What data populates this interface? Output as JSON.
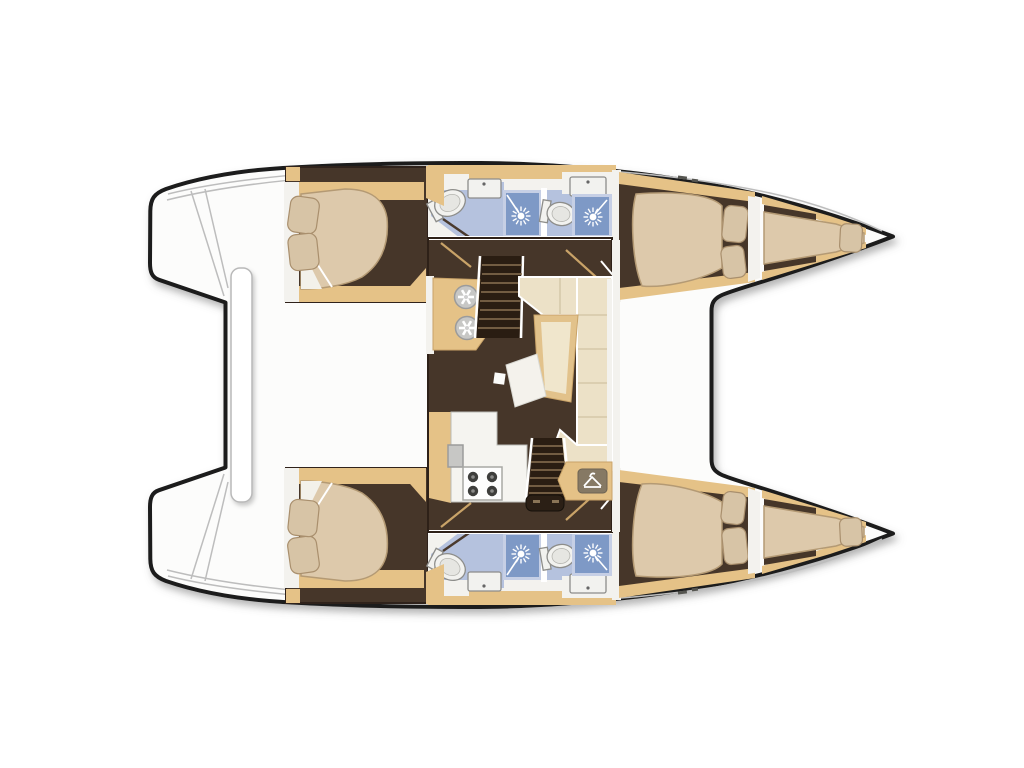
{
  "meta": {
    "title": "Catamaran floor plan — top view, 4 double cabins, 4 heads, 2 bow berths, central saloon",
    "image_type": "boat-layout-diagram",
    "orientation": "bows-pointing-right"
  },
  "palette": {
    "outline": "#1a1a1a",
    "deck": "#fcfcfb",
    "deckLine": "#bdbdbd",
    "wood": "#e5c287",
    "floorDark": "#463629",
    "bedCream": "#ddc9ab",
    "bedEdge": "#b49a74",
    "pillow": "#d7c4a6",
    "pillowEdge": "#a98f6d",
    "sheetWhite": "#f3f1ea",
    "bathFloor": "#b5c2de",
    "showerBlue": "#7e99c6",
    "showerFrame": "#c6cfe5",
    "fixtureWhite": "#f2f2ef",
    "fixtureStroke": "#8d8d8a",
    "sofaCream": "#ece1c7",
    "sofaSeam": "#d5c8a8",
    "tableTan": "#e2c28b",
    "padCream": "#f0e6cc",
    "stairDark": "#2a1d12",
    "stairTread": "#8a7252",
    "sinkGray": "#c7c7c5",
    "burnerDark": "#3e3e3c",
    "badgeGray": "#867964",
    "thresholdDark": "#2b1f15",
    "doorTan": "#c9a368",
    "white": "#ffffff"
  },
  "vessel": {
    "type": "catamaran",
    "hulls": [
      {
        "id": "upper-hull",
        "aft_cabin": {
          "bed": "double-berth",
          "pillows": 2
        },
        "heads": [
          {
            "id": "aft-head",
            "fixtures": [
              "toilet",
              "washbasin",
              "shower"
            ]
          },
          {
            "id": "forward-head",
            "fixtures": [
              "toilet",
              "washbasin",
              "shower"
            ]
          }
        ],
        "forward_cabin": {
          "bed": "double-berth",
          "pillows": 2
        },
        "bow_berth": {
          "bed": "single-berth",
          "pillows": 1
        }
      },
      {
        "id": "lower-hull",
        "aft_cabin": {
          "bed": "double-berth",
          "pillows": 2
        },
        "heads": [
          {
            "id": "aft-head",
            "fixtures": [
              "toilet",
              "washbasin",
              "shower"
            ]
          },
          {
            "id": "forward-head",
            "fixtures": [
              "toilet",
              "washbasin",
              "shower"
            ]
          }
        ],
        "forward_cabin": {
          "bed": "double-berth",
          "pillows": 2
        },
        "bow_berth": {
          "bed": "single-berth",
          "pillows": 1
        }
      }
    ],
    "saloon": {
      "fixtures": [
        "galley-counter-with-twin-round-sinks",
        "galley-counter-with-4-burner-stove",
        "rectangular-sink",
        "l-shaped-sofa",
        "angled-table-with-cushion",
        "tilted-coffee-table",
        "wardrobe-seat-with-hanger-icon",
        "companionway-stairs-upper-hull",
        "companionway-stairs-lower-hull",
        "aft-door-threshold"
      ]
    },
    "deck": {
      "features": [
        "twin-bow-points",
        "stern-platforms-with-step-lines",
        "aft-center-bench",
        "side-deck-lines"
      ]
    }
  }
}
